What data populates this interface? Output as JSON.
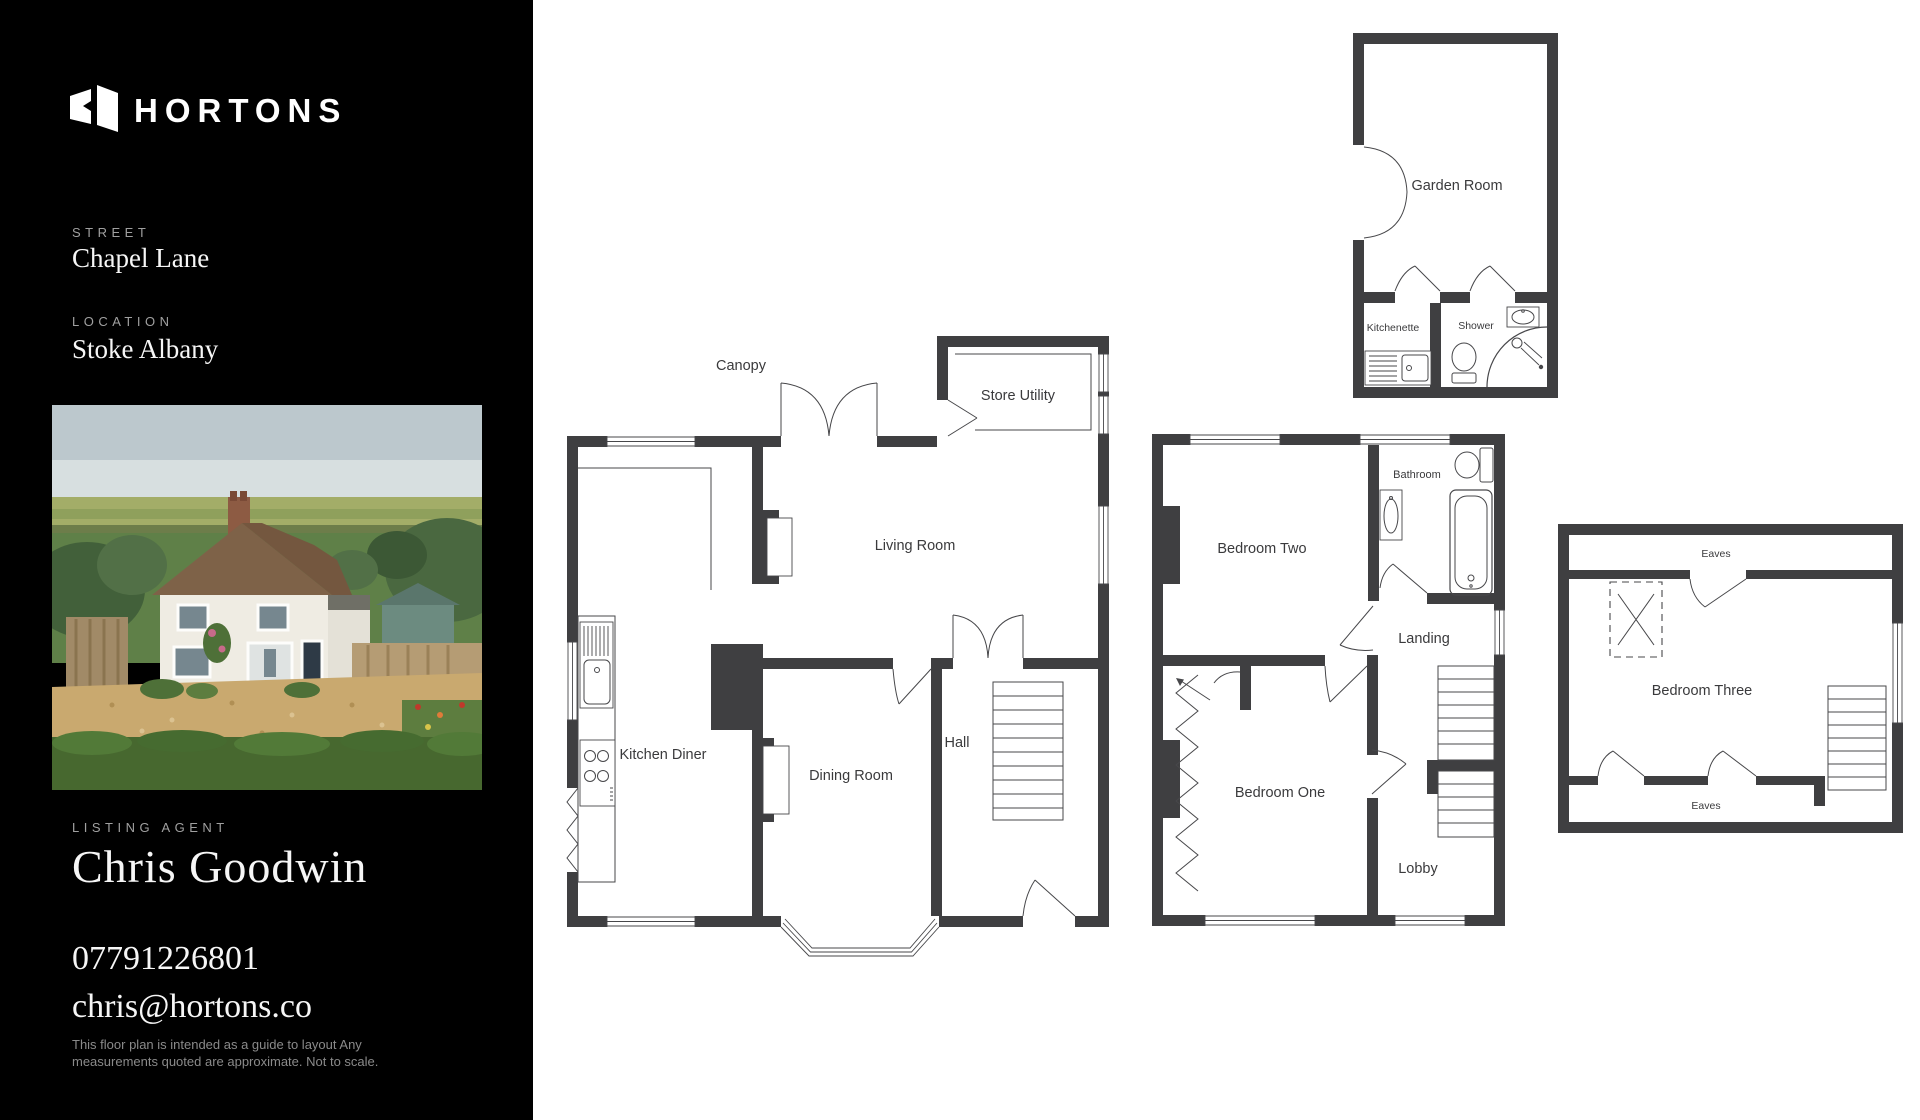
{
  "sidebar": {
    "brand": "HORTONS",
    "street_label": "STREET",
    "street_value": "Chapel Lane",
    "location_label": "LOCATION",
    "location_value": "Stoke Albany",
    "agent_label": "LISTING AGENT",
    "agent_name": "Chris Goodwin",
    "agent_phone": "07791226801",
    "agent_email": "chris@hortons.co",
    "disclaimer_line1": "This floor plan is intended  as a guide to layout Any",
    "disclaimer_line2": "measurements quoted are approximate. Not to scale."
  },
  "floorplans": {
    "ground": {
      "canopy": "Canopy",
      "store_utility": "Store Utility",
      "living_room": "Living Room",
      "kitchen_diner": "Kitchen Diner",
      "dining_room": "Dining Room",
      "hall": "Hall"
    },
    "first": {
      "bedroom_two": "Bedroom Two",
      "bathroom": "Bathroom",
      "landing": "Landing",
      "bedroom_one": "Bedroom One",
      "lobby": "Lobby"
    },
    "garden": {
      "garden_room": "Garden Room",
      "kitchenette": "Kitchenette",
      "shower": "Shower"
    },
    "second": {
      "eaves_top": "Eaves",
      "bedroom_three": "Bedroom Three",
      "eaves_bottom": "Eaves"
    }
  },
  "colors": {
    "sidebar_bg": "#000000",
    "wall": "#3f3f41",
    "plan_label": "#3a3a3c",
    "sidebar_muted": "#a0a0a0",
    "background": "#ffffff"
  }
}
